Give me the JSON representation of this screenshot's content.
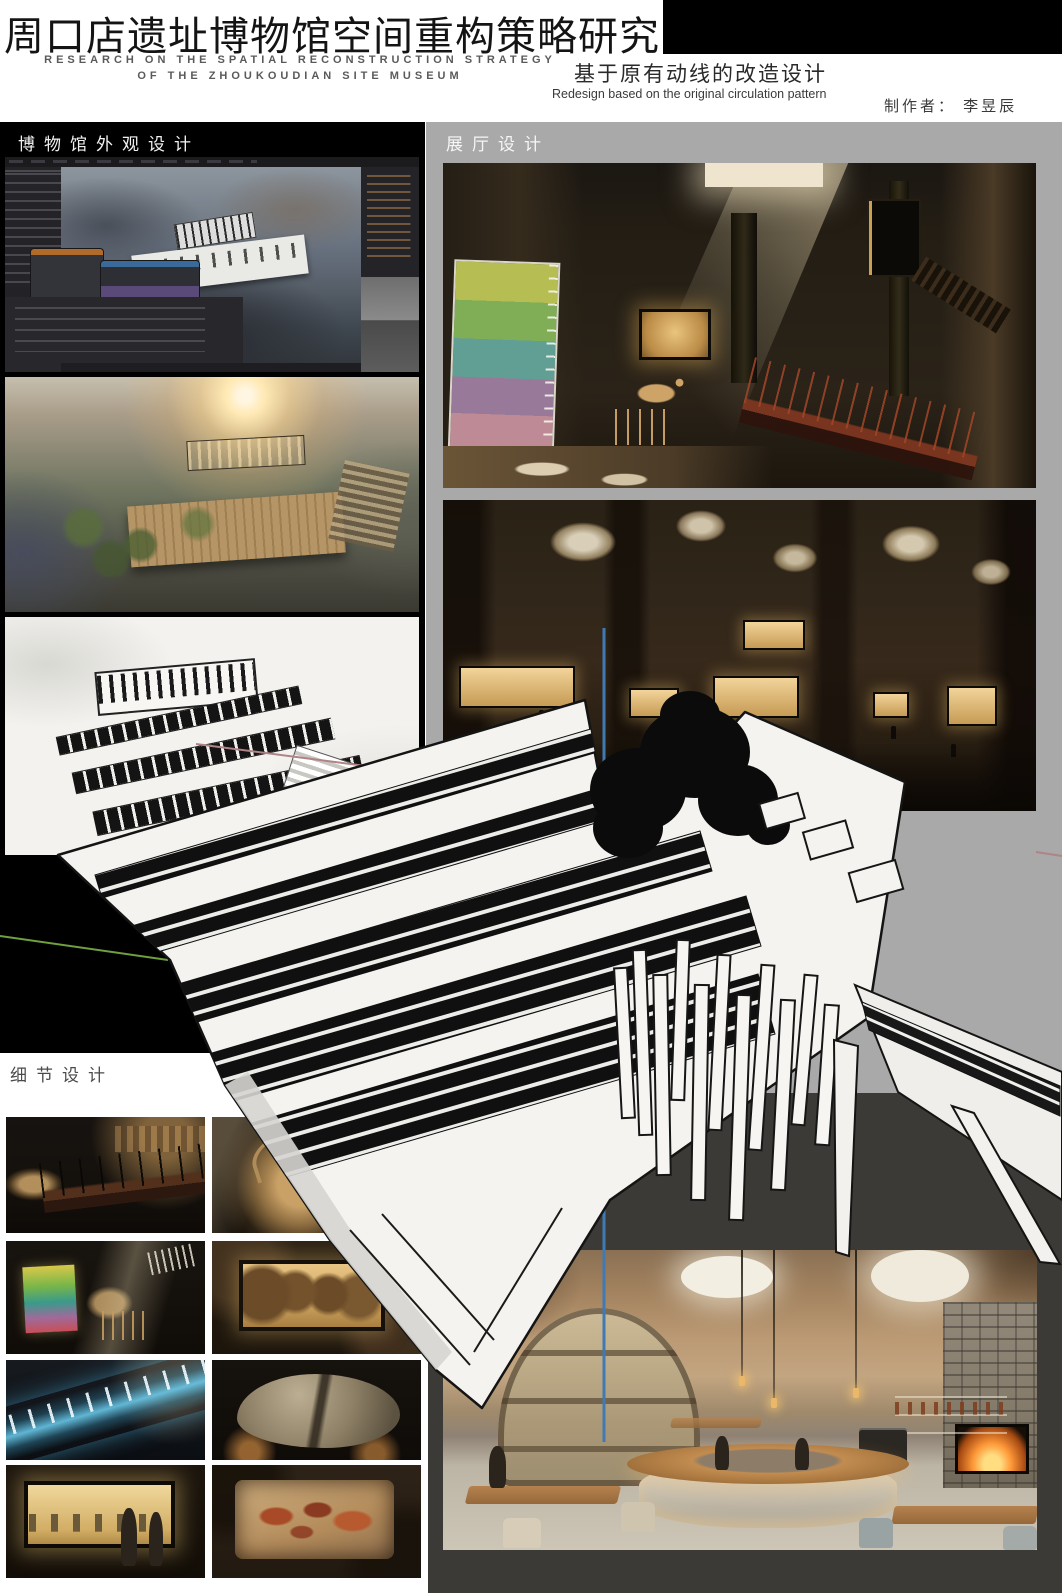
{
  "header": {
    "title": "周口店遗址博物馆空间重构策略研究",
    "subtitle_line1": "RESEARCH ON THE SPATIAL RECONSTRUCTION STRATEGY",
    "subtitle_line2": "OF THE ZHOUKOUDIAN SITE MUSEUM",
    "theme_cn": "基于原有动线的改造设计",
    "theme_en": "Redesign based on the original circulation pattern",
    "creator": "制作者： 李昱辰"
  },
  "sections": {
    "exterior_label": "博物馆外观设计",
    "hall_label": "展厅设计",
    "detail_label": "细节设计"
  },
  "colors": {
    "left_backdrop": "#000000",
    "right_backdrop": "#a9a9a9",
    "dark_panel": "#3b3a36",
    "axis_red": "#b08484",
    "axis_green": "#6f9f3f",
    "axis_blue": "#3f7ab5"
  }
}
